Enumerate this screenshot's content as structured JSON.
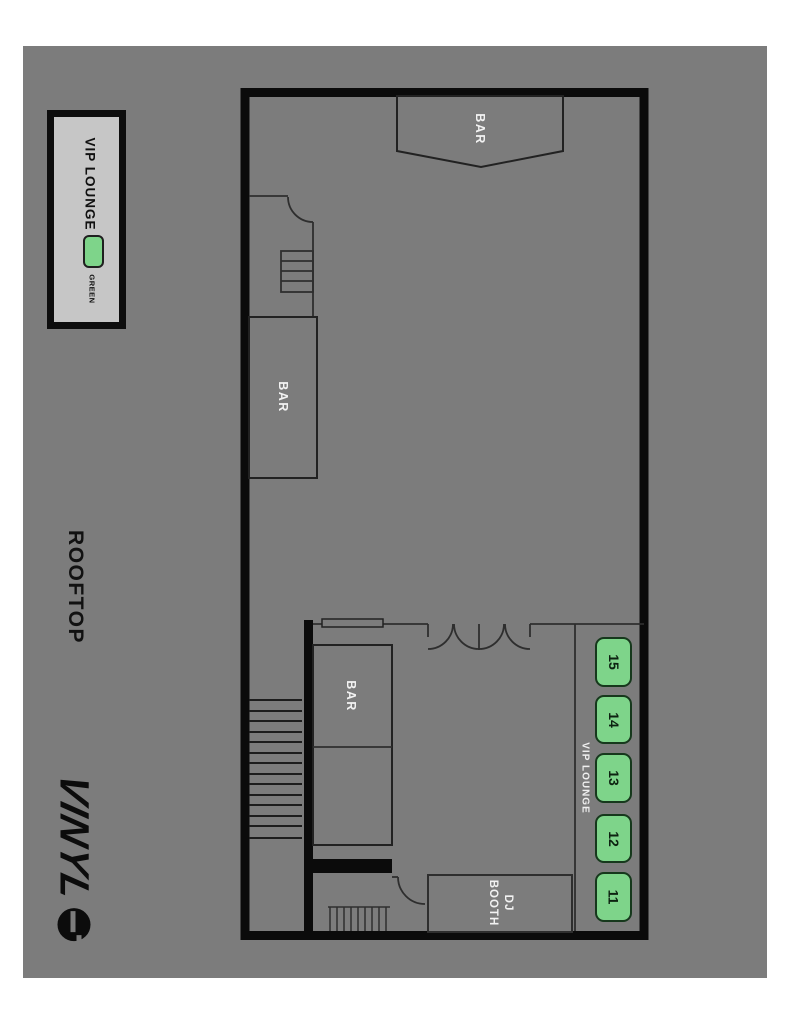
{
  "colors": {
    "canvas_gray": "#7c7c7c",
    "wall_black": "#0b0b0b",
    "table_green": "#7ed48a",
    "legend_bg": "#c6c6c6"
  },
  "rooftop_label": "ROOFTOP",
  "brand": {
    "name": "VINYL"
  },
  "legend": {
    "title": "VIP LOUNGE",
    "swatch_label": "GREEN",
    "swatch_color": "#7ed48a"
  },
  "plan": {
    "bar_top": {
      "label": "BAR"
    },
    "bar_mid": {
      "label": "BAR"
    },
    "bar_lower": {
      "label": "BAR"
    },
    "dj_booth": {
      "label": "DJ BOOTH"
    },
    "vip": {
      "label": "VIP LOUNGE",
      "tables": [
        {
          "number": "15"
        },
        {
          "number": "14"
        },
        {
          "number": "13"
        },
        {
          "number": "12"
        },
        {
          "number": "11"
        }
      ]
    }
  }
}
